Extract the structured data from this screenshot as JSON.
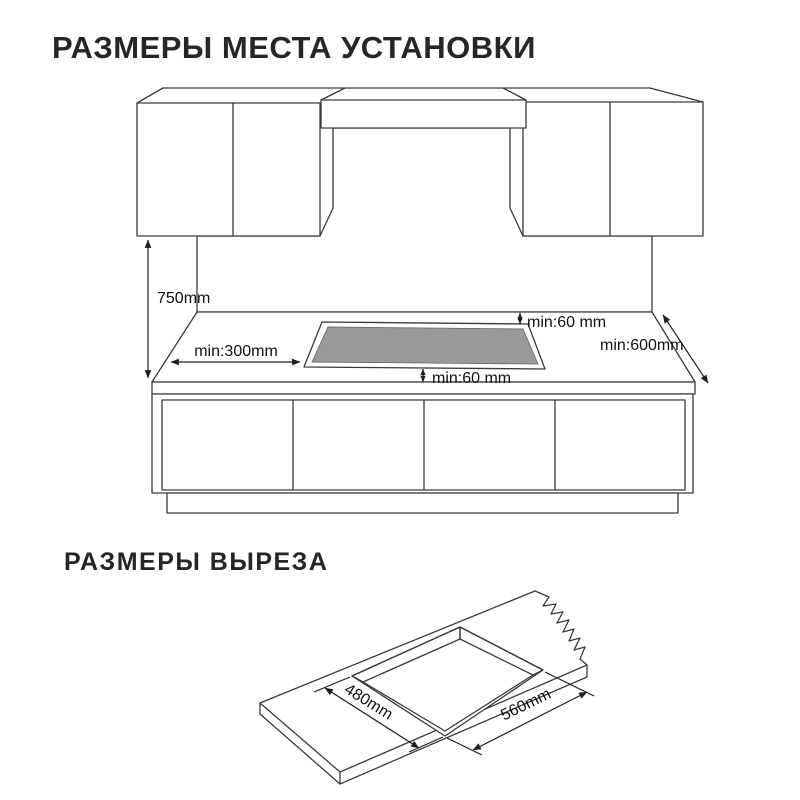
{
  "page": {
    "background": "#ffffff",
    "line_color": "#3a3a3a"
  },
  "section_installation": {
    "title": "РАЗМЕРЫ МЕСТА УСТАНОВКИ",
    "labels": {
      "wall_height": "750mm",
      "side_clearance_left": "min:300mm",
      "back_clearance": "min:60 mm",
      "side_clearance_right": "min:600mm",
      "front_clearance": "min:60 mm"
    },
    "colors": {
      "backsplash": "#e9e9e9",
      "cooktop": "#9a9a9a"
    }
  },
  "section_cutout": {
    "title": "РАЗМЕРЫ ВЫРЕЗА",
    "labels": {
      "cutout_depth": "480mm",
      "cutout_width": "560mm"
    },
    "colors": {
      "cut_edge": "#d9d9d9"
    }
  }
}
